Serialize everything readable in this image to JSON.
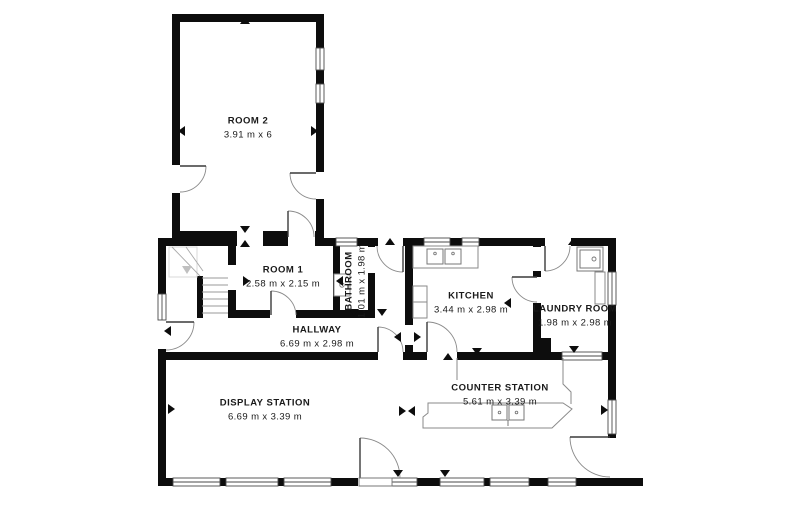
{
  "title": "Floor plan",
  "colors": {
    "wall": "#0d0d0d",
    "window_stroke": "#4a4a4a",
    "door_leaf": "#3a3a3a",
    "door_arc": "#8a8a8a",
    "fixture": "#8a8a8a",
    "text": "#1a1a1a",
    "background": "#ffffff"
  },
  "rooms": [
    {
      "id": "room-2",
      "name": "ROOM 2",
      "dims": "3.91 m x 6",
      "x": 248,
      "y": 121,
      "rotated": false
    },
    {
      "id": "room-1",
      "name": "ROOM 1",
      "dims": "2.58 m x 2.15 m",
      "x": 283,
      "y": 270,
      "rotated": false
    },
    {
      "id": "bathroom",
      "name": "BATHROOM",
      "dims": "1.01 m x 1.98 m",
      "x": 349,
      "y": 281,
      "rotated": true
    },
    {
      "id": "hallway",
      "name": "HALLWAY",
      "dims": "6.69 m x 2.98 m",
      "x": 317,
      "y": 330,
      "rotated": false
    },
    {
      "id": "kitchen",
      "name": "KITCHEN",
      "dims": "3.44 m x 2.98 m",
      "x": 471,
      "y": 296,
      "rotated": false
    },
    {
      "id": "laundry-room",
      "name": "LAUNDRY ROOM",
      "dims": "1.98 m x 2.98 m",
      "x": 575,
      "y": 309,
      "rotated": false
    },
    {
      "id": "display-station",
      "name": "DISPLAY STATION",
      "dims": "6.69 m x 3.39 m",
      "x": 265,
      "y": 403,
      "rotated": false
    },
    {
      "id": "counter-station",
      "name": "COUNTER STATION",
      "dims": "5.61 m x 3.39 m",
      "x": 500,
      "y": 388,
      "rotated": false
    }
  ],
  "plan": {
    "width": 800,
    "height": 522,
    "walls": [
      [
        172,
        14,
        152,
        8
      ],
      [
        172,
        14,
        8,
        151
      ],
      [
        172,
        193,
        8,
        53
      ],
      [
        316,
        14,
        8,
        34
      ],
      [
        316,
        70,
        8,
        14
      ],
      [
        316,
        103,
        8,
        69
      ],
      [
        316,
        199,
        8,
        47
      ],
      [
        172,
        231,
        65,
        8
      ],
      [
        263,
        231,
        25,
        8
      ],
      [
        315,
        231,
        9,
        8
      ],
      [
        158,
        238,
        79,
        8
      ],
      [
        263,
        238,
        25,
        8
      ],
      [
        315,
        238,
        21,
        8
      ],
      [
        357,
        238,
        21,
        8
      ],
      [
        403,
        238,
        21,
        8
      ],
      [
        450,
        238,
        12,
        8
      ],
      [
        479,
        238,
        66,
        8
      ],
      [
        571,
        238,
        45,
        8
      ],
      [
        158,
        238,
        8,
        56
      ],
      [
        158,
        349,
        8,
        137
      ],
      [
        608,
        238,
        8,
        34
      ],
      [
        608,
        305,
        8,
        95
      ],
      [
        608,
        434,
        8,
        4
      ],
      [
        158,
        478,
        15,
        8
      ],
      [
        220,
        478,
        6,
        8
      ],
      [
        278,
        478,
        6,
        8
      ],
      [
        331,
        478,
        27,
        8
      ],
      [
        417,
        478,
        23,
        8
      ],
      [
        484,
        478,
        6,
        8
      ],
      [
        529,
        478,
        19,
        8
      ],
      [
        576,
        478,
        67,
        8
      ],
      [
        158,
        352,
        220,
        8
      ],
      [
        403,
        352,
        24,
        8
      ],
      [
        457,
        352,
        105,
        8
      ],
      [
        602,
        352,
        14,
        8
      ],
      [
        228,
        238,
        8,
        27
      ],
      [
        228,
        290,
        8,
        28
      ],
      [
        228,
        310,
        42,
        8
      ],
      [
        296,
        310,
        79,
        8
      ],
      [
        333,
        238,
        7,
        72
      ],
      [
        368,
        238,
        7,
        9
      ],
      [
        368,
        273,
        7,
        37
      ],
      [
        405,
        238,
        8,
        87
      ],
      [
        405,
        345,
        8,
        7
      ],
      [
        533,
        238,
        8,
        9
      ],
      [
        533,
        271,
        8,
        6
      ],
      [
        533,
        303,
        8,
        49
      ],
      [
        541,
        338,
        10,
        14
      ],
      [
        197,
        276,
        6,
        42
      ]
    ],
    "windows": [
      [
        316,
        48,
        8,
        22
      ],
      [
        316,
        84,
        8,
        19
      ],
      [
        336,
        238,
        21,
        8
      ],
      [
        424,
        238,
        26,
        8
      ],
      [
        462,
        238,
        17,
        8
      ],
      [
        158,
        294,
        8,
        26
      ],
      [
        608,
        272,
        8,
        33
      ],
      [
        608,
        400,
        8,
        34
      ],
      [
        562,
        352,
        40,
        8
      ],
      [
        173,
        478,
        47,
        8
      ],
      [
        226,
        478,
        52,
        8
      ],
      [
        284,
        478,
        47,
        8
      ],
      [
        392,
        478,
        25,
        8
      ],
      [
        440,
        478,
        44,
        8
      ],
      [
        490,
        478,
        39,
        8
      ],
      [
        548,
        478,
        28,
        8
      ]
    ],
    "doors": [
      {
        "leaf": "M180,166 L206,166",
        "arc": "M206,166 A26,26 0 0 1 180,192"
      },
      {
        "leaf": "M316,173 L290,173",
        "arc": "M290,173 A26,26 0 0 0 316,199"
      },
      {
        "leaf": "M288,211 L288,237",
        "arc": "M288,211 A26,26 0 0 1 314,237"
      },
      {
        "leaf": "M271,291 L271,315",
        "arc": "M271,291 A25,25 0 0 1 296,315"
      },
      {
        "leaf": "M403,246 L403,272",
        "arc": "M377,246 A26,26 0 0 0 403,272"
      },
      {
        "leaf": "M545,246 L545,271",
        "arc": "M545,271 A25,25 0 0 0 570,246"
      },
      {
        "leaf": "M512,277 L537,277",
        "arc": "M512,277 A25,25 0 0 0 537,302"
      },
      {
        "leaf": "M427,322 L427,352",
        "arc": "M427,322 A30,30 0 0 1 457,352"
      },
      {
        "leaf": "M378,327 L378,352",
        "arc": "M378,327 A25,25 0 0 1 403,352"
      },
      {
        "leaf": "M166,322 L194,322",
        "arc": "M194,322 A28,28 0 0 1 166,350"
      },
      {
        "leaf": "M360,438 L360,478",
        "arc": "M360,438 A40,40 0 0 1 400,478"
      },
      {
        "leaf": "M570,437 L610,437",
        "arc": "M570,437 A40,40 0 0 0 610,477"
      }
    ],
    "fixtures": [
      {
        "name": "stairs-landing",
        "path": "M169,247 H197 V277 H169 Z",
        "stroke": "#d9d9d9",
        "fill": "none",
        "w": 1
      },
      {
        "name": "stairs-treads",
        "path": "M202,278 H228 M202,285 H228 M202,292 H228 M202,299 H228 M202,306 H228 M202,313 H228",
        "stroke": "#999999",
        "fill": "none",
        "w": 0.9
      },
      {
        "name": "stairs-diagonals",
        "path": "M172,247 L200,276 M186,247 L203,271",
        "stroke": "#aaaaaa",
        "fill": "none",
        "w": 0.9
      },
      {
        "name": "stairs-walk-arrow",
        "path": "M182,266 L192,266 L187,274 Z",
        "stroke": "none",
        "fill": "#c0c0c0",
        "w": 1
      },
      {
        "name": "kitchen-counter",
        "path": "M413,246 H478 V268 H413 Z",
        "stroke": "#8a8a8a",
        "fill": "#ffffff",
        "w": 1
      },
      {
        "name": "kitchen-sink",
        "path": "M427,249 h16 v15 h-16 Z M445,249 h16 v15 h-16 Z",
        "stroke": "#777777",
        "fill": "#ffffff",
        "w": 1
      },
      {
        "name": "kitchen-fridge",
        "path": "M413,286 h14 v32 h-14 Z M413,302 h14",
        "stroke": "#8a8a8a",
        "fill": "#ffffff",
        "w": 1
      },
      {
        "name": "bathroom-sink",
        "path": "M334,274 h16 v22 h-16 Z",
        "stroke": "#8a8a8a",
        "fill": "#ffffff",
        "w": 1
      },
      {
        "name": "laundry-sink",
        "path": "M577,247 h26 v24 h-26 Z M580,250 h20 v18 h-20 Z",
        "stroke": "#777777",
        "fill": "#ffffff",
        "w": 1
      },
      {
        "name": "laundry-counter",
        "path": "M595,272 h10 v32 h-10 Z",
        "stroke": "#8a8a8a",
        "fill": "#ffffff",
        "w": 1
      },
      {
        "name": "counter-island",
        "path": "M428,403 H563 L572,409 L552,428 H423 V417 L428,413 Z",
        "stroke": "#8a8a8a",
        "fill": "#ffffff",
        "w": 1
      },
      {
        "name": "counter-partition-left",
        "path": "M457,358 V380",
        "stroke": "#8a8a8a",
        "fill": "none",
        "w": 1
      },
      {
        "name": "counter-partition-right",
        "path": "M563,358 L563,384 L571,392 L571,404",
        "stroke": "#8a8a8a",
        "fill": "none",
        "w": 1
      },
      {
        "name": "counter-sink",
        "path": "M492,405 h15 v15 h-15 Z M509,405 h15 v15 h-15 Z M508,420 v6",
        "stroke": "#777777",
        "fill": "#ffffff",
        "w": 1
      },
      {
        "name": "entry-door-sill",
        "path": "M359,478 h33 v8 h-33 Z",
        "stroke": "#777777",
        "fill": "#ffffff",
        "w": 0.9
      }
    ],
    "circles": [
      {
        "name": "kitchen-sink-tap",
        "cx": 435,
        "cy": 253.5,
        "r": 1.3
      },
      {
        "name": "kitchen-sink-tap",
        "cx": 453,
        "cy": 253.5,
        "r": 1.3
      },
      {
        "name": "bathroom-sink-drain",
        "cx": 342,
        "cy": 285,
        "r": 2.2
      },
      {
        "name": "laundry-sink-drain",
        "cx": 594,
        "cy": 259,
        "r": 2
      },
      {
        "name": "counter-sink-tap",
        "cx": 499.5,
        "cy": 412.5,
        "r": 1.3
      },
      {
        "name": "counter-sink-tap",
        "cx": 516.5,
        "cy": 412.5,
        "r": 1.3
      }
    ],
    "markers": [
      [
        245,
        21,
        "up"
      ],
      [
        182,
        131,
        "left"
      ],
      [
        314,
        131,
        "right"
      ],
      [
        245,
        229,
        "down"
      ],
      [
        245,
        244,
        "up"
      ],
      [
        390,
        242,
        "up"
      ],
      [
        573,
        242,
        "up"
      ],
      [
        246,
        281,
        "right"
      ],
      [
        340,
        281,
        "left"
      ],
      [
        354,
        312,
        "down"
      ],
      [
        382,
        312,
        "down"
      ],
      [
        398,
        337,
        "left"
      ],
      [
        417,
        337,
        "right"
      ],
      [
        508,
        303,
        "left"
      ],
      [
        448,
        357,
        "up"
      ],
      [
        477,
        351,
        "down"
      ],
      [
        574,
        349,
        "down"
      ],
      [
        171,
        409,
        "right"
      ],
      [
        402,
        411,
        "right"
      ],
      [
        412,
        411,
        "left"
      ],
      [
        604,
        410,
        "right"
      ],
      [
        398,
        473,
        "down"
      ],
      [
        445,
        473,
        "down"
      ],
      [
        168,
        331,
        "left"
      ]
    ]
  }
}
